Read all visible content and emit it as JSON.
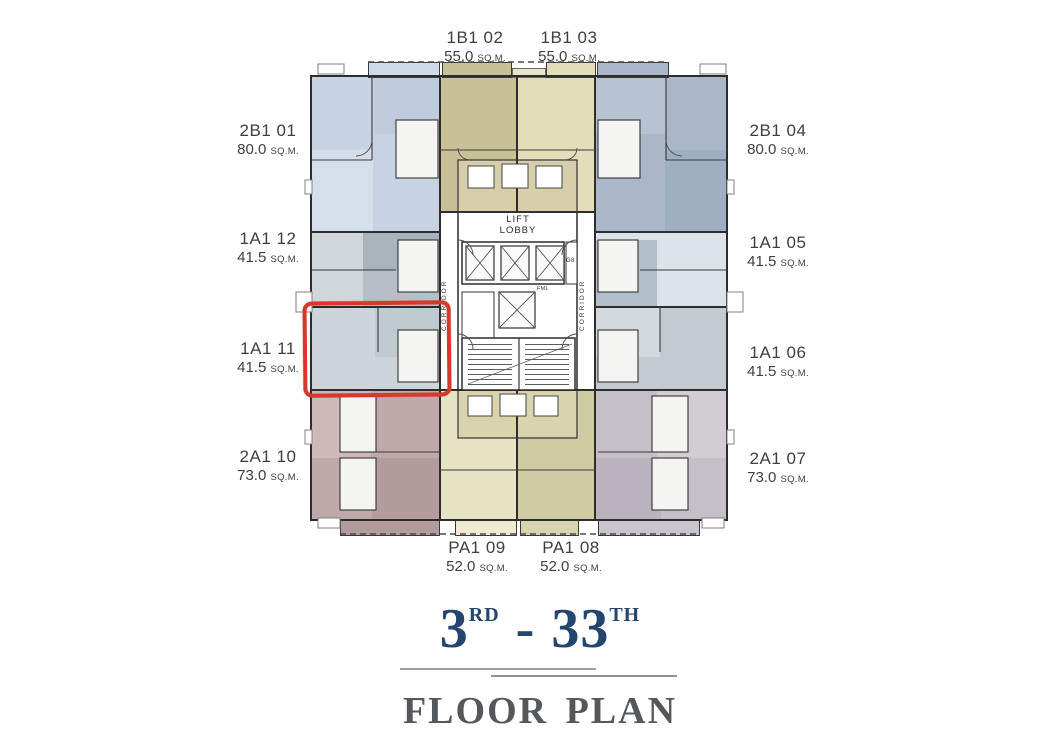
{
  "page": {
    "background": "#ffffff"
  },
  "plan": {
    "lift_lobby_line1": "LIFT",
    "lift_lobby_line2": "LOBBY",
    "corridor_left": "CORRIDOR",
    "corridor_right": "CORRIDOR",
    "room_g8": "G8",
    "fireman_lift": "FML",
    "highlight_color": "#d7382b",
    "highlighted_unit": "1A1 11"
  },
  "units": [
    {
      "id": "2B1 01",
      "area_value": "80.0",
      "area_unit": "SQ.M.",
      "color": "#c7d3e2",
      "highlighted": false
    },
    {
      "id": "1B1 02",
      "area_value": "55.0",
      "area_unit": "SQ.M.",
      "color": "#c8c198",
      "highlighted": false
    },
    {
      "id": "1B1 03",
      "area_value": "55.0",
      "area_unit": "SQ.M.",
      "color": "#e3ddba",
      "highlighted": false
    },
    {
      "id": "2B1 04",
      "area_value": "80.0",
      "area_unit": "SQ.M.",
      "color": "#a9b7c8",
      "highlighted": false
    },
    {
      "id": "1A1 12",
      "area_value": "41.5",
      "area_unit": "SQ.M.",
      "color": "#b6bfc7",
      "highlighted": false
    },
    {
      "id": "1A1 05",
      "area_value": "41.5",
      "area_unit": "SQ.M.",
      "color": "#dde3e8",
      "highlighted": false
    },
    {
      "id": "1A1 11",
      "area_value": "41.5",
      "area_unit": "SQ.M.",
      "color": "#cdd5da",
      "highlighted": true
    },
    {
      "id": "1A1 06",
      "area_value": "41.5",
      "area_unit": "SQ.M.",
      "color": "#c4cad0",
      "highlighted": false
    },
    {
      "id": "2A1 10",
      "area_value": "73.0",
      "area_unit": "SQ.M.",
      "color": "#c0a9ab",
      "highlighted": false
    },
    {
      "id": "2A1 07",
      "area_value": "73.0",
      "area_unit": "SQ.M.",
      "color": "#c5bfc8",
      "highlighted": false
    },
    {
      "id": "PA1 09",
      "area_value": "52.0",
      "area_unit": "SQ.M.",
      "color": "#e7e3c5",
      "highlighted": false
    },
    {
      "id": "PA1 08",
      "area_value": "52.0",
      "area_unit": "SQ.M.",
      "color": "#cfcca3",
      "highlighted": false
    }
  ],
  "footer": {
    "floor_from": "3",
    "floor_from_suffix": "RD",
    "separator": "-",
    "floor_to": "33",
    "floor_to_suffix": "TH",
    "title": "FLOOR PLAN",
    "range_color": "#24456e",
    "title_color": "#55585b"
  }
}
